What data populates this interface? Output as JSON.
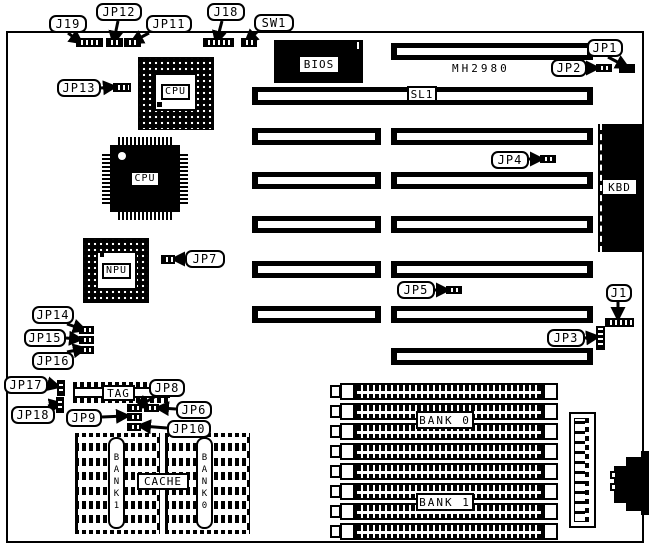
{
  "board": {
    "model_text": "MH2980"
  },
  "chips": {
    "bios": "BIOS",
    "cpu_socket": "CPU",
    "cpu_qfp": "CPU",
    "npu": "NPU",
    "kbd": "KBD",
    "tag": "TAG"
  },
  "labels": {
    "slot_sl1": "SL1",
    "cache": "CACHE",
    "cache_bank1_vertical": "BANK1",
    "cache_bank0_vertical": "BANK0",
    "mem_bank0": "BANK 0",
    "mem_bank1": "BANK 1"
  },
  "callouts": {
    "j19": "J19",
    "jp12": "JP12",
    "jp11": "JP11",
    "j18": "J18",
    "sw1": "SW1",
    "jp1": "JP1",
    "jp2": "JP2",
    "jp13": "JP13",
    "jp4": "JP4",
    "jp7": "JP7",
    "jp5": "JP5",
    "j1": "J1",
    "jp3": "JP3",
    "jp14": "JP14",
    "jp15": "JP15",
    "jp16": "JP16",
    "jp17": "JP17",
    "jp18": "JP18",
    "jp8": "JP8",
    "jp6": "JP6",
    "jp9": "JP9",
    "jp10": "JP10"
  },
  "colors": {
    "ink": "#000000",
    "paper": "#ffffff"
  }
}
